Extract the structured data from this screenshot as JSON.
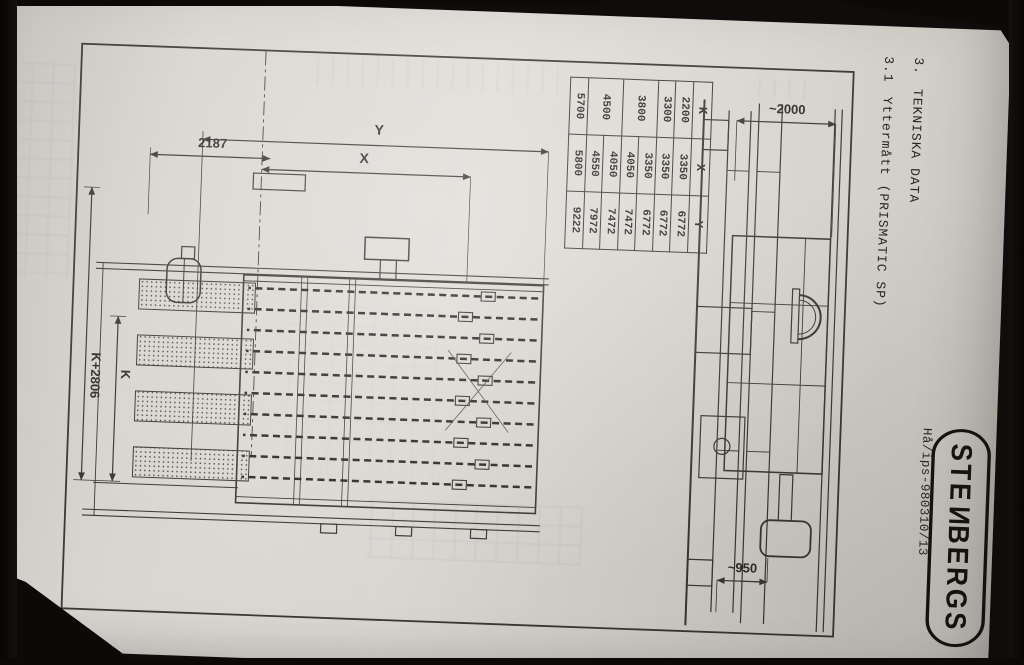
{
  "page": {
    "section": {
      "number": "3.",
      "title": "TEKNISKA DATA"
    },
    "subsection": {
      "number": "3.1",
      "title": "Yttermått (PRISMATIC SP)"
    },
    "doc_ref": "Hå/ips-980310/13",
    "logo": {
      "pre": "STE",
      "flipped_letter": "N",
      "post": "BERGS"
    }
  },
  "dim_table": {
    "headers": [
      "K",
      "X",
      "Y"
    ],
    "rows": [
      [
        "2200",
        "3350",
        "6772"
      ],
      [
        "3300",
        "3350",
        "6772"
      ],
      [
        "3800",
        "3350",
        "6772"
      ],
      [
        "",
        "4050",
        "7472"
      ],
      [
        "4500",
        "4050",
        "7472"
      ],
      [
        "",
        "4550",
        "7972"
      ],
      [
        "5700",
        "5800",
        "9222"
      ]
    ]
  },
  "drawing": {
    "plan_labels": {
      "overall_length": "Y",
      "working_length": "X",
      "infeed": "2187",
      "k_plus": "K+2806",
      "k": "K"
    },
    "side_labels": {
      "height": "~2000",
      "outfeed_height": "~950"
    }
  },
  "colors": {
    "paper": "#d9d6d0",
    "ink": "#3a3833",
    "photo_background": "#0e0d0b",
    "bleed_ghost": "#8d95a5"
  }
}
